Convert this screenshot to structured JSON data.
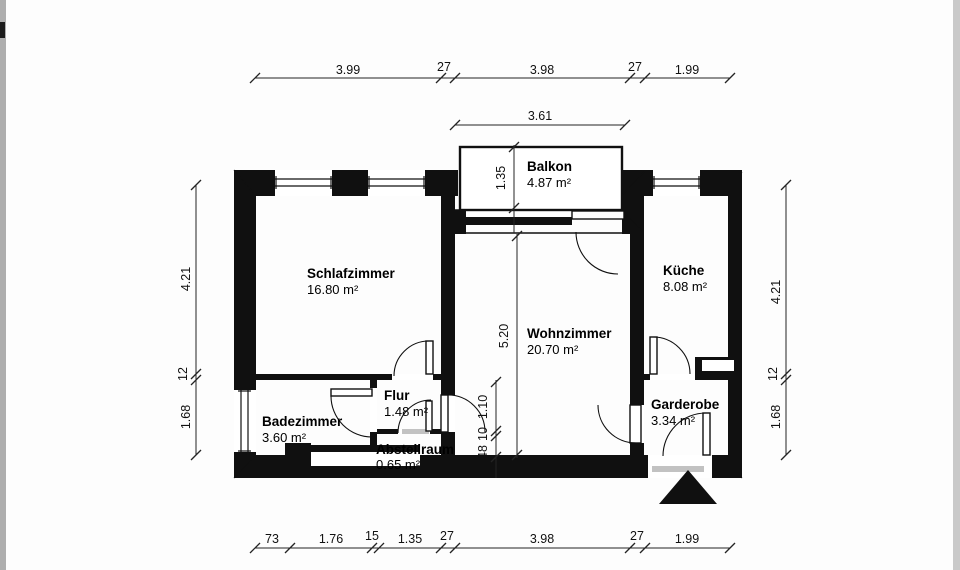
{
  "plan": {
    "type": "apartment-floor-plan",
    "rooms": [
      {
        "id": "schlafzimmer",
        "name": "Schlafzimmer",
        "area": "16.80 m²"
      },
      {
        "id": "wohnzimmer",
        "name": "Wohnzimmer",
        "area": "20.70 m²"
      },
      {
        "id": "kueche",
        "name": "Küche",
        "area": "8.08 m²"
      },
      {
        "id": "balkon",
        "name": "Balkon",
        "area": "4.87 m²"
      },
      {
        "id": "badezimmer",
        "name": "Badezimmer",
        "area": "3.60 m²"
      },
      {
        "id": "flur",
        "name": "Flur",
        "area": "1.48 m²"
      },
      {
        "id": "abstellraum",
        "name": "Abstellraum",
        "area": "0.65 m²"
      },
      {
        "id": "garderobe",
        "name": "Garderobe",
        "area": "3.34 m²"
      }
    ]
  },
  "dimensions": {
    "top": [
      "3.99",
      "27",
      "3.98",
      "27",
      "1.99"
    ],
    "balcony": {
      "width": "3.61",
      "depth": "1.35"
    },
    "sides": [
      "4.21",
      "12",
      "1.68"
    ],
    "bottom": [
      "73",
      "1.76",
      "15",
      "1.35",
      "27",
      "3.98",
      "27",
      "1.99"
    ],
    "interior": {
      "living_height": "5.20",
      "door": "1.10",
      "wall": "10",
      "storage": "48"
    }
  },
  "colors": {
    "wall": "#101010",
    "paper": "#fdfdfd",
    "threshold": "#c2c2c2"
  }
}
